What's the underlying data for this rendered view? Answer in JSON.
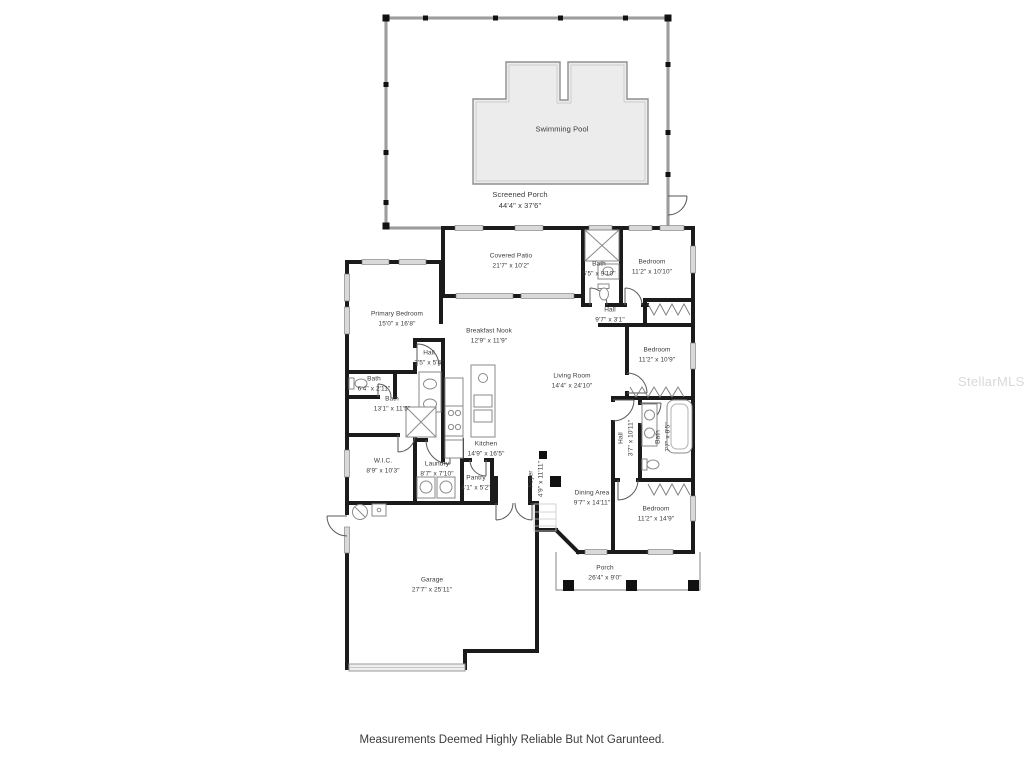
{
  "watermark": "StellarMLS",
  "footer": "Measurements Deemed Highly Reliable But Not Garunteed.",
  "rooms": [
    {
      "name": "Swimming Pool",
      "dims": ""
    },
    {
      "name": "Screened Porch",
      "dims": "44'4\" x 37'6\""
    },
    {
      "name": "Covered Patio",
      "dims": "21'7\" x 10'2\""
    },
    {
      "name": "Bath",
      "dims": "5'5\" x 9'10\""
    },
    {
      "name": "Bedroom",
      "dims": "11'2\" x 10'10\""
    },
    {
      "name": "Hall",
      "dims": "9'7\" x 3'1\""
    },
    {
      "name": "Primary Bedroom",
      "dims": "15'0\" x 16'8\""
    },
    {
      "name": "Breakfast Nook",
      "dims": "12'9\" x 11'9\""
    },
    {
      "name": "Living Room",
      "dims": "14'4\" x 24'10\""
    },
    {
      "name": "Bedroom",
      "dims": "11'2\" x 10'9\""
    },
    {
      "name": "Hall",
      "dims": "3'5\" x 5'4\""
    },
    {
      "name": "Bath",
      "dims": "6'4\" x 2'11\""
    },
    {
      "name": "Bath",
      "dims": "13'1\" x 11'5\""
    },
    {
      "name": "Kitchen",
      "dims": "14'9\" x 16'5\""
    },
    {
      "name": "W.I.C.",
      "dims": "8'9\" x 10'3\""
    },
    {
      "name": "Laundry",
      "dims": "8'7\" x 7'10\""
    },
    {
      "name": "Pantry",
      "dims": "4'1\" x 5'2\""
    },
    {
      "name": "Foyer",
      "dims": "4'9\" x 11'11\""
    },
    {
      "name": "Hall",
      "dims": "3'7\" x 10'11\""
    },
    {
      "name": "Bath",
      "dims": "7'7\" x 8'5\""
    },
    {
      "name": "Dining Area",
      "dims": "9'7\" x 14'11\""
    },
    {
      "name": "Bedroom",
      "dims": "11'2\" x 14'9\""
    },
    {
      "name": "Porch",
      "dims": "26'4\" x 9'0\""
    },
    {
      "name": "Garage",
      "dims": "27'7\" x 25'11\""
    }
  ],
  "colors": {
    "wall": "#1b1b1b",
    "pool_fill": "#ececec",
    "window_fill": "#d9d9d9",
    "watermark": "#d9d9d9"
  }
}
